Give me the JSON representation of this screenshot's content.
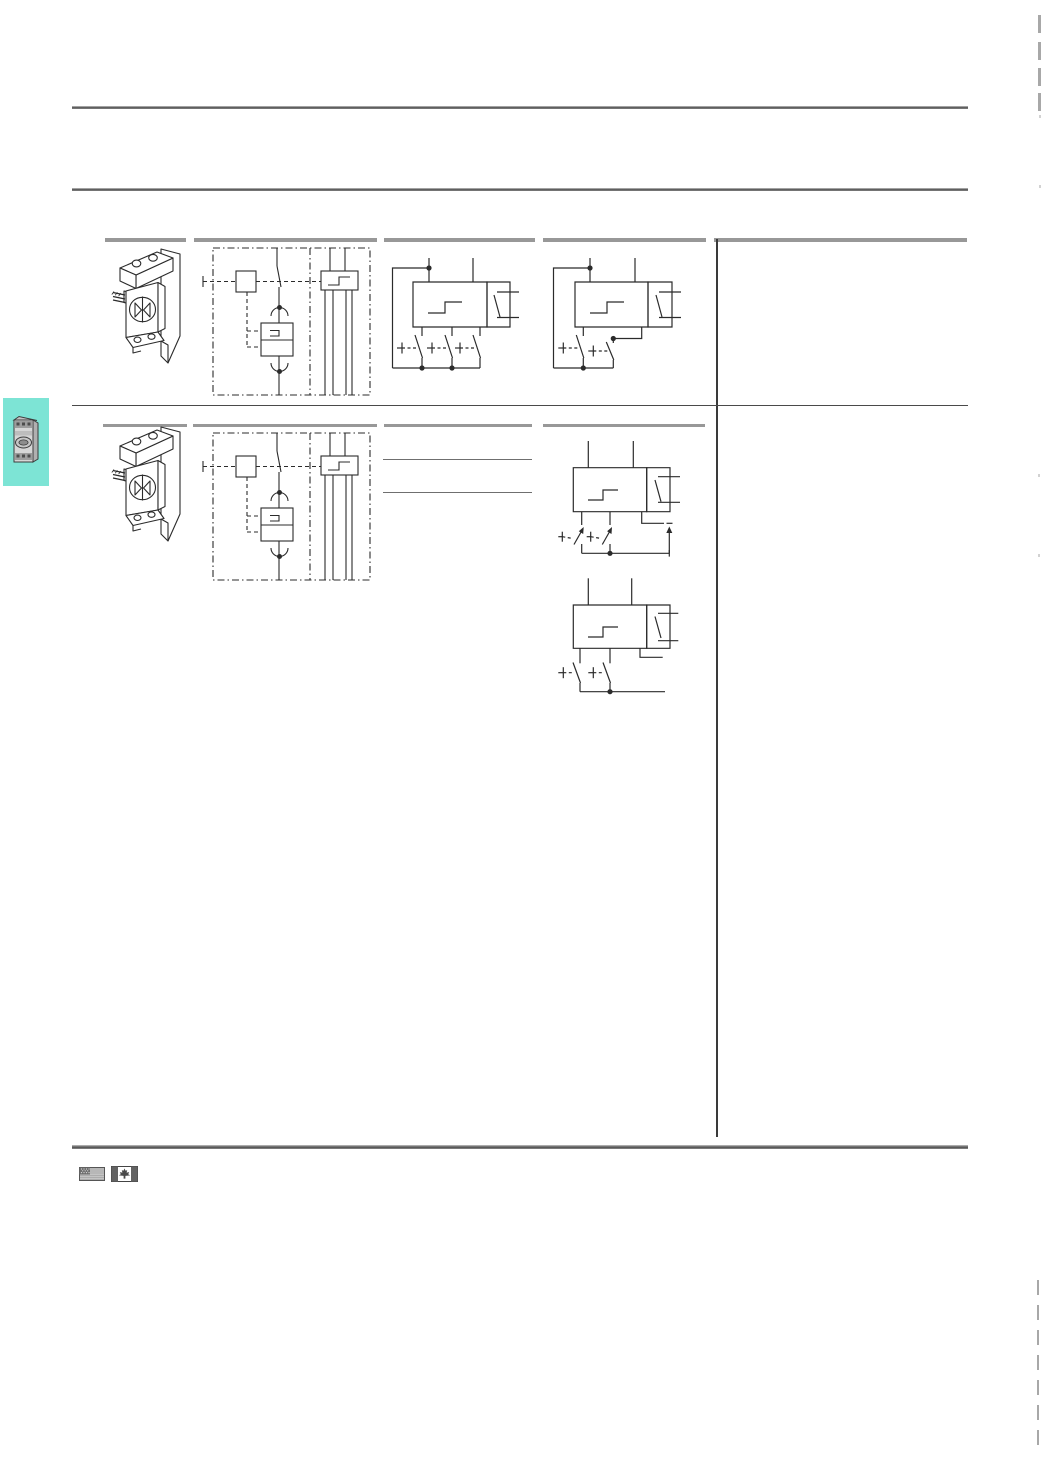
{
  "page": {
    "kind": "catalog-page-scan",
    "background": "#ffffff",
    "text_content": ""
  },
  "colors": {
    "tab_accent": "#7de4d5",
    "rule_gray": "#6f6f6f",
    "header_bar_gray": "#989898",
    "line_dark": "#2b2b2b",
    "crop_mark_gray": "#a8a8a8"
  },
  "sidebar_tab": {
    "icon": "motor-protective-circuit-breaker-photo-icon"
  },
  "table": {
    "rows": [
      {
        "cells": [
          "release-module-isometric-drawing",
          "internal-wiring-schematic",
          "release-with-three-aux-contacts-diagram",
          "release-with-two-aux-contacts-diagram",
          ""
        ]
      },
      {
        "cells": [
          "release-module-isometric-drawing",
          "internal-wiring-schematic",
          "",
          "early-make-contacts-dc-diagram; two-aux-contacts-diagram",
          ""
        ]
      }
    ]
  },
  "footer": {
    "icons": [
      "us-flag-icon",
      "canada-flag-icon"
    ]
  }
}
